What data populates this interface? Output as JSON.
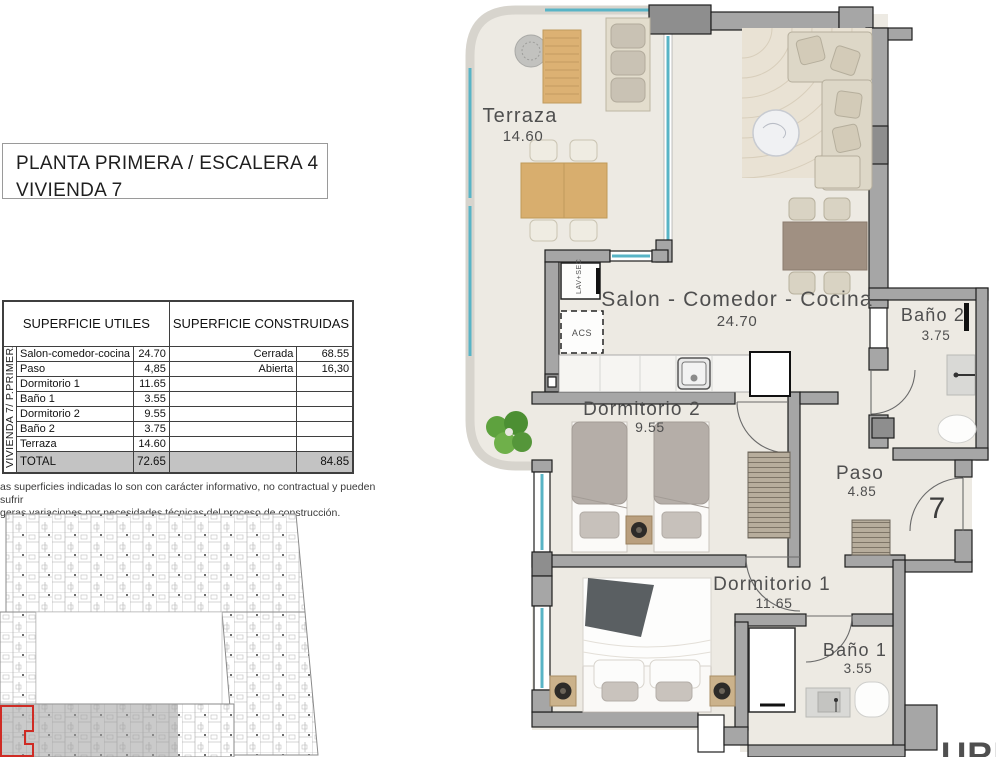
{
  "title_box": {
    "line1": "PLANTA PRIMERA / ESCALERA 4",
    "line2": "VIVIENDA 7"
  },
  "area_table": {
    "side_label": "VIVIENDA 7/ P.PRIMERA",
    "header_left": "SUPERFICIE UTILES",
    "header_right": "SUPERFICIE CONSTRUIDAS",
    "rows": [
      {
        "name": "Salon-comedor-cocina",
        "value": "24.70",
        "right_name": "Cerrada",
        "right_value": "68.55"
      },
      {
        "name": "Paso",
        "value": "4,85",
        "right_name": "Abierta",
        "right_value": "16,30"
      },
      {
        "name": "Dormitorio 1",
        "value": "11.65",
        "right_name": "",
        "right_value": ""
      },
      {
        "name": "Baño 1",
        "value": "3.55",
        "right_name": "",
        "right_value": ""
      },
      {
        "name": "Dormitorio 2",
        "value": "9.55",
        "right_name": "",
        "right_value": ""
      },
      {
        "name": "Baño 2",
        "value": "3.75",
        "right_name": "",
        "right_value": ""
      },
      {
        "name": "Terraza",
        "value": "14.60",
        "right_name": "",
        "right_value": ""
      }
    ],
    "total": {
      "name": "TOTAL",
      "value": "72.65",
      "right_name": "",
      "right_value": "84.85"
    }
  },
  "disclaimer": {
    "line1": "as superficies indicadas lo son con carácter informativo, no contractual y pueden sufrir",
    "line2": "geras variaciones por necesidades técnicas del proceso de construcción."
  },
  "floorplan": {
    "rooms": [
      {
        "name": "Terraza",
        "area": "14.60"
      },
      {
        "name": "Salon - Comedor - Cocina",
        "area": "24.70"
      },
      {
        "name": "Dormitorio 2",
        "area": "9.55"
      },
      {
        "name": "Paso",
        "area": "4.85"
      },
      {
        "name": "Dormitorio 1",
        "area": "11.65"
      },
      {
        "name": "Baño 1",
        "area": "3.55"
      },
      {
        "name": "Baño 2",
        "area": "3.75"
      }
    ],
    "unit_number": "7",
    "labels": {
      "lav_sec": "LAV+SEC",
      "acs": "ACS"
    }
  },
  "logo": {
    "partial_text": "URN"
  },
  "colors": {
    "glass_teal": "#58b4c6",
    "wall_gray": "#a6a6a6",
    "highlight_red": "#cf2b24",
    "total_row_gray": "#c3c3c3",
    "floor_beige": "#edeae3"
  }
}
